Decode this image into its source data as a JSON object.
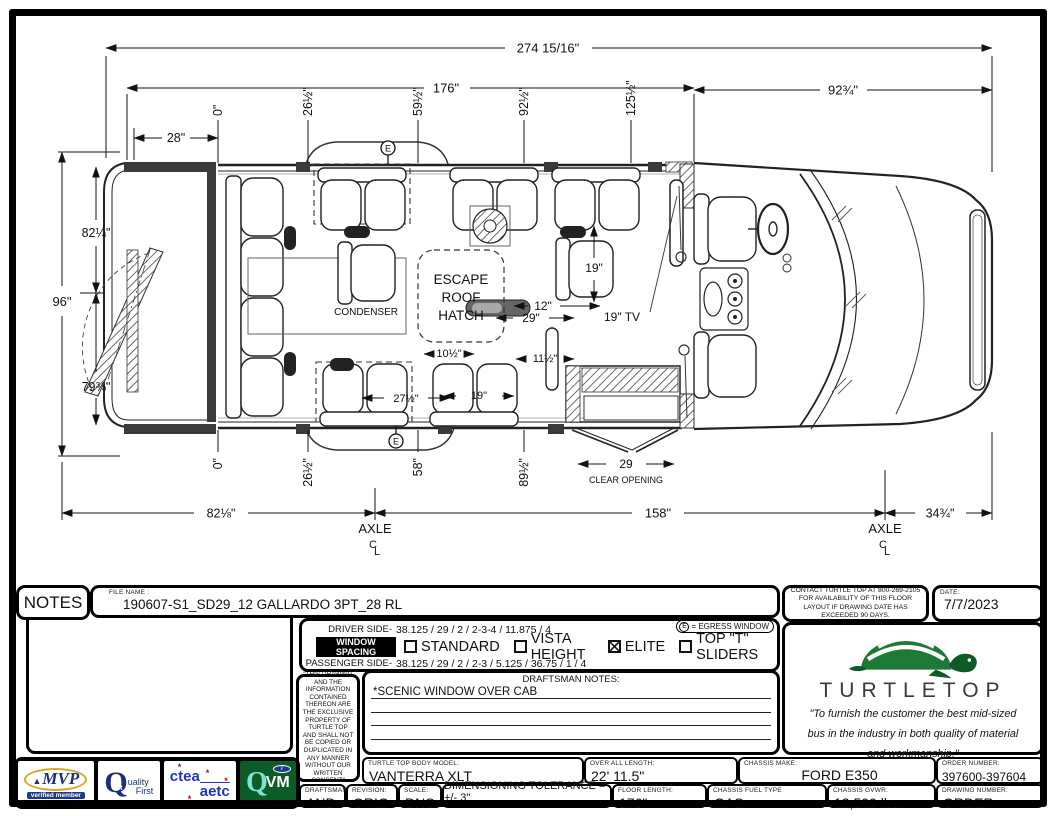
{
  "sheet": {
    "notes_label": "NOTES",
    "file_name_label": "FILE NAME :",
    "file_name": "190607-S1_SD29_12 GALLARDO 3PT_28 RL",
    "contact": "CONTACT TURTLE TOP AT 800-269-2105 FOR AVAILABILITY OF THIS FLOOR LAYOUT IF DRAWING DATE HAS EXCEEDED 90 DAYS.",
    "date_label": "DATE:",
    "date": "7/7/2023"
  },
  "window_spacing": {
    "driver_label": "DRIVER SIDE-",
    "driver_values": "38.125 / 29 / 2 / 2-3-4 / 11.875 / 4",
    "title": "WINDOW SPACING",
    "passenger_label": "PASSENGER SIDE-",
    "passenger_values": "38.125 / 29 / 2 / 2-3 / 5.125 / 36.75 / 1 / 4",
    "options": [
      {
        "label": "STANDARD",
        "checked": false
      },
      {
        "label": "VISTA HEIGHT",
        "checked": false
      },
      {
        "label": "ELITE",
        "checked": true
      },
      {
        "label": "TOP \"T\" SLIDERS",
        "checked": false
      }
    ],
    "egress_symbol": "E",
    "egress_legend": "= EGRESS WINDOW"
  },
  "legal": "\"THIS DRAWING AND THE INFORMATION CONTAINED THEREON ARE THE EXCLUSIVE PROPERTY OF TURTLE TOP AND SHALL NOT BE COPIED OR DUPLICATED IN ANY MANNER WITHOUT OUR WRITTEN CONSENT\"",
  "draftsman_notes": {
    "header": "DRAFTSMAN NOTES:",
    "line1": "*SCENIC WINDOW OVER CAB"
  },
  "brand": {
    "name": "TURTLETOP",
    "quote1": "\"To furnish the customer the best mid-sized",
    "quote2": "bus in the industry in both quality of material",
    "quote3": "and workmanship.\""
  },
  "logos": {
    "mvp_tri": "▲",
    "mvp_word": "MVP",
    "mvp_bottom": "verified member",
    "q1_q": "Q",
    "q1_sup": "1st",
    "q1_mid": "uality",
    "q1_bottom": "First",
    "ctea": "ctea",
    "aetc": "aetc",
    "star": "*",
    "qvm_q": "Q",
    "qvm_vm": "VM",
    "ford": "F"
  },
  "title_block": {
    "model_label": "TURTLE TOP BODY MODEL:",
    "model": "VANTERRA XLT",
    "oal_label": "OVER ALL LENGTH:",
    "oal": "22' 11.5\"",
    "chassis_make_label": "CHASSIS MAKE:",
    "chassis_make": "FORD E350",
    "order_label": "ORDER NUMBER:",
    "order": "397600-397604",
    "draftsman_label": "DRAFTSMAN:",
    "draftsman": "AND",
    "revision_label": "REVISION:",
    "revision": "ORIG",
    "scale_label": "SCALE:",
    "scale": "DNS",
    "tolerance": "DIMENSIONING TOLERANCE = +/- 3\"",
    "floor_label": "FLOOR LENGTH:",
    "floor": "176\"",
    "fuel_label": "CHASSIS FUEL TYPE",
    "fuel": "GAS",
    "gvwr_label": "CHASSIS GVWR:",
    "gvwr": "12,500 lbs.",
    "drawing_no_label": "DRAWING NUMBER:",
    "drawing_no": "ORDER"
  },
  "drawing": {
    "dim_overall": "274 15/16\"",
    "dim_floor": "176\"",
    "dim_front_section": "92¾\"",
    "dim_rear_overhang": "28\"",
    "top_marks": [
      "0\"",
      "26½\"",
      "59½\"",
      "92½\"",
      "125½\""
    ],
    "bottom_marks": [
      "0\"",
      "26½\"",
      "58\"",
      "89½\""
    ],
    "dim_overall_width": "96\"",
    "dim_body_front": "82¼\"",
    "dim_body_rear": "79¾\"",
    "dim_rear_axle": "82⅛\"",
    "dim_wheelbase": "158\"",
    "dim_front_overhang": "34¾\"",
    "axle_label": "AXLE",
    "cl_c": "C",
    "cl_l": "L",
    "hatch_line1": "ESCAPE",
    "hatch_line2": "ROOF",
    "hatch_line3": "HATCH",
    "condenser_label": "CONDENSER",
    "tv_label": "19\" TV",
    "dim_seat_19_driver": "19\"",
    "dim_seat_19_pass": "19\"",
    "dim_12": "12\"",
    "dim_29": "29\"",
    "dim_10_5": "10½\"",
    "dim_11_5": "11½\"",
    "dim_27_5": "27½\"",
    "clear_opening_value": "29",
    "clear_opening_label": "CLEAR OPENING",
    "egress_letter": "E"
  }
}
